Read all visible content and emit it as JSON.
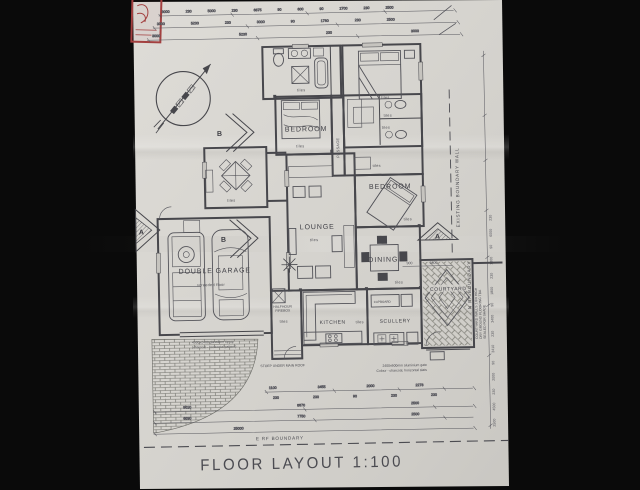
{
  "title": "FLOOR LAYOUT 1:100",
  "rooms": {
    "bedroom_top": {
      "label": "BEDROOM",
      "floor": "tiles"
    },
    "main_bedroom": {
      "floor": "tiles"
    },
    "ensuite": {
      "floor": "tiles"
    },
    "hall_bath_1": {
      "floor": "tiles"
    },
    "hall_bath_2": {
      "floor": "tiles"
    },
    "hall": {
      "floor": "tiles"
    },
    "passage": {
      "label": "PASSAGE"
    },
    "bedroom_right": {
      "label": "BEDROOM",
      "floor": "tiles"
    },
    "lounge": {
      "label": "LOUNGE",
      "floor": "tiles"
    },
    "dining": {
      "label": "DINING",
      "floor": "tiles"
    },
    "kitchen": {
      "label": "KITCHEN",
      "floor": "tiles"
    },
    "scullery": {
      "label": "SCULLERY"
    },
    "cupboard": {
      "label": "CUPBOARD"
    },
    "courtyard": {
      "label": "COURTYARD"
    },
    "garage": {
      "label": "DOUBLE GARAGE",
      "floor": "screeded floor"
    },
    "patio": {
      "floor": "tiles"
    },
    "stoep": {
      "floor": "tiles"
    }
  },
  "annotations": {
    "garage_door_1": "4900x2400 glassfibre tip-up",
    "garage_door_2": "(charcoal - horizontal pattern)",
    "gate_1": "2400x600mm aluminium gate",
    "gate_2": "Colour - charcoal, horizontal slats",
    "stoep_note": "STOEP UNDER MAIN ROOF",
    "firebox_1": "HALFHOUR",
    "firebox_2": "FIREBOX",
    "courtyard_note_1": "COURTYARD WALLS 1.8m HIGH",
    "courtyard_note_2": "DRY GROUND FLOORING TBA",
    "courtyard_note_3": "SEALED FOR SHADE",
    "boundary_bottom": "E RF BOUNDARY",
    "boundary_right_wall": "EXISTING BOUNDARY WALL",
    "boundary_right": "N RF BOUNDARY"
  },
  "section_markers": {
    "a": "A",
    "b": "B"
  },
  "dimensions": {
    "top_row_1": [
      "3000",
      "230",
      "5000",
      "230",
      "6875",
      "90",
      "600",
      "90",
      "2700",
      "230",
      "2500"
    ],
    "top_row_2": [
      "3000",
      "5230",
      "230",
      "3000",
      "90",
      "1780",
      "230",
      "2500"
    ],
    "top_row_3": [
      "3000",
      "5230",
      "230",
      "3000"
    ],
    "right_chain": [
      "2500",
      "4500",
      "230",
      "2000",
      "90",
      "3410",
      "230",
      "3400",
      "90",
      "1800",
      "230",
      "1300",
      "90",
      "6000",
      "230"
    ],
    "bottom_row_1": [
      "1100",
      "3455",
      "2000",
      "2278"
    ],
    "bottom_row_1b": [
      "230",
      "230",
      "90",
      "230",
      "230"
    ],
    "bottom_row_2": [
      "9010",
      "8870",
      "2500"
    ],
    "bottom_row_3": [
      "6030",
      "7750",
      "2500"
    ],
    "bottom_row_4": [
      "25000"
    ],
    "courtyard": [
      "900",
      "1800"
    ]
  }
}
